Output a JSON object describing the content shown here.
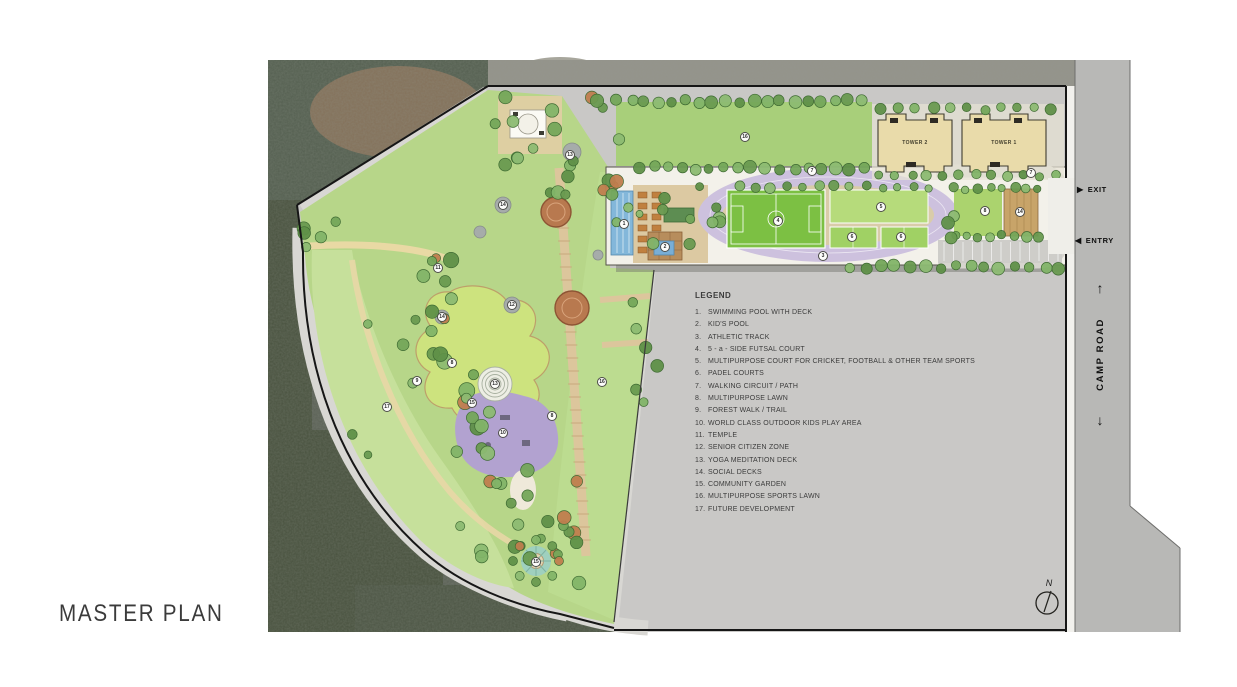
{
  "title": "MASTER PLAN",
  "plan": {
    "towers": [
      {
        "label": "TOWER 2"
      },
      {
        "label": "TOWER 1"
      }
    ],
    "road": {
      "name": "CAMP ROAD",
      "exit_label": "EXIT",
      "entry_label": "ENTRY"
    },
    "compass": {
      "north_label": "N"
    }
  },
  "legend": {
    "title": "LEGEND",
    "items": [
      {
        "num": "1",
        "label": "SWIMMING POOL WITH DECK"
      },
      {
        "num": "2",
        "label": "KID'S POOL"
      },
      {
        "num": "3",
        "label": "ATHLETIC TRACK"
      },
      {
        "num": "4",
        "label": "5 - a - SIDE FUTSAL COURT"
      },
      {
        "num": "5",
        "label": "MULTIPURPOSE COURT FOR CRICKET, FOOTBALL & OTHER TEAM SPORTS"
      },
      {
        "num": "6",
        "label": "PADEL COURTS"
      },
      {
        "num": "7",
        "label": "WALKING CIRCUIT / PATH"
      },
      {
        "num": "8",
        "label": "MULTIPURPOSE LAWN"
      },
      {
        "num": "9",
        "label": "FOREST WALK / TRAIL"
      },
      {
        "num": "10",
        "label": "WORLD CLASS OUTDOOR KIDS PLAY AREA"
      },
      {
        "num": "11",
        "label": "TEMPLE"
      },
      {
        "num": "12",
        "label": "SENIOR CITIZEN ZONE"
      },
      {
        "num": "13",
        "label": "YOGA MEDITATION DECK"
      },
      {
        "num": "14",
        "label": "SOCIAL DECKS"
      },
      {
        "num": "15",
        "label": "COMMUNITY GARDEN"
      },
      {
        "num": "16",
        "label": "MULTIPURPOSE SPORTS LAWN"
      },
      {
        "num": "17",
        "label": "FUTURE DEVELOPMENT"
      }
    ]
  },
  "markers": [
    {
      "n": "1",
      "x": 624,
      "y": 224
    },
    {
      "n": "2",
      "x": 665,
      "y": 247
    },
    {
      "n": "3",
      "x": 823,
      "y": 256
    },
    {
      "n": "4",
      "x": 778,
      "y": 221
    },
    {
      "n": "5",
      "x": 881,
      "y": 207
    },
    {
      "n": "6",
      "x": 852,
      "y": 237
    },
    {
      "n": "6",
      "x": 901,
      "y": 237
    },
    {
      "n": "7",
      "x": 812,
      "y": 171
    },
    {
      "n": "7",
      "x": 1031,
      "y": 173
    },
    {
      "n": "8",
      "x": 452,
      "y": 363
    },
    {
      "n": "8",
      "x": 552,
      "y": 416
    },
    {
      "n": "8",
      "x": 985,
      "y": 211
    },
    {
      "n": "9",
      "x": 417,
      "y": 381
    },
    {
      "n": "10",
      "x": 503,
      "y": 433
    },
    {
      "n": "11",
      "x": 438,
      "y": 268
    },
    {
      "n": "12",
      "x": 512,
      "y": 305
    },
    {
      "n": "13",
      "x": 570,
      "y": 155
    },
    {
      "n": "13",
      "x": 495,
      "y": 384
    },
    {
      "n": "14",
      "x": 503,
      "y": 205
    },
    {
      "n": "14",
      "x": 442,
      "y": 317
    },
    {
      "n": "14",
      "x": 1020,
      "y": 212
    },
    {
      "n": "15",
      "x": 472,
      "y": 403
    },
    {
      "n": "15",
      "x": 536,
      "y": 562
    },
    {
      "n": "16",
      "x": 745,
      "y": 137
    },
    {
      "n": "16",
      "x": 602,
      "y": 382
    },
    {
      "n": "17",
      "x": 387,
      "y": 407
    }
  ],
  "colors": {
    "site_gray": "#c9c8c6",
    "road_gray": "#b8b8b6",
    "park_green": "#b7d689",
    "lawn_bright": "#cde37e",
    "track_lavender": "#cdc1de",
    "field_green": "#7cc043",
    "pool_blue": "#83b7da",
    "play_purple": "#b2a2d0",
    "tower_tan": "#e9dbaa"
  }
}
